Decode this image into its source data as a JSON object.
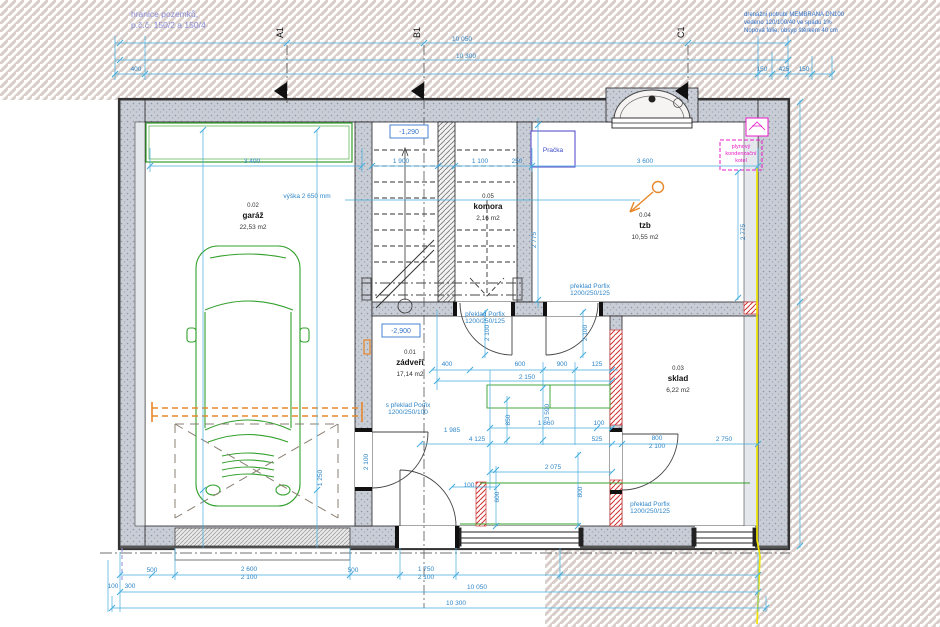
{
  "drawing": {
    "site_note": {
      "line1": "hranice pozemků,",
      "line2": "p.č.č. 150/2 a 150/4"
    },
    "drain_note": {
      "line1": "drenážní potrubí MEMBRANA DN100",
      "line2": "vedeno 120/100/40 ve spádu 1%",
      "line3": "Nopová fólie, obsyp štěrkem 40 cm"
    },
    "section_markers": {
      "a": "A1",
      "b": "B1",
      "c": "C1"
    },
    "rooms": [
      {
        "number": "0.01",
        "name": "zádveří",
        "area": "17,14 m2"
      },
      {
        "number": "0.02",
        "name": "garáž",
        "area": "22,53 m2"
      },
      {
        "number": "0.03",
        "name": "sklad",
        "area": "6,22 m2"
      },
      {
        "number": "0.04",
        "name": "tzb",
        "area": "10,55 m2"
      },
      {
        "number": "0.05",
        "name": "komora",
        "area": "2,16 m2"
      }
    ],
    "levels": {
      "stair": "-1,290",
      "floor": "-2,900"
    },
    "equipment": {
      "washer": "Pračka",
      "boiler_line1": "plynový",
      "boiler_line2": "kondenzační",
      "boiler_line3": "kotel"
    },
    "colors": {
      "dim": "#2f86c8",
      "dimline": "#45aede",
      "green": "#33a02c",
      "orange": "#e8872a",
      "magenta": "#e81cc8",
      "violet": "#8d8fd6",
      "red": "#cf3333",
      "yellow": "#f0e400"
    },
    "dim_labels": [
      {
        "t": "10 050",
        "x": 462,
        "y": 41
      },
      {
        "t": "10 300",
        "x": 466,
        "y": 58
      },
      {
        "t": "150",
        "x": 762,
        "y": 71
      },
      {
        "t": "425",
        "x": 784,
        "y": 71
      },
      {
        "t": "150",
        "x": 804,
        "y": 71
      },
      {
        "t": "400",
        "x": 136,
        "y": 71
      },
      {
        "t": "3 400",
        "x": 252,
        "y": 163
      },
      {
        "t": "1 900",
        "x": 401,
        "y": 163
      },
      {
        "t": "1 100",
        "x": 480,
        "y": 163
      },
      {
        "t": "250",
        "x": 517,
        "y": 163
      },
      {
        "t": "3 600",
        "x": 645,
        "y": 163
      },
      {
        "t": "výška 2 650 mm",
        "x": 307,
        "y": 198
      },
      {
        "t": "2 775",
        "x": 745,
        "y": 232,
        "r": -90
      },
      {
        "t": "2 775",
        "x": 536,
        "y": 240,
        "r": -90
      },
      {
        "t": "1 250",
        "x": 322,
        "y": 478,
        "r": -90
      },
      {
        "t": "2 100",
        "x": 368,
        "y": 462,
        "r": -90
      },
      {
        "t": "400",
        "x": 447,
        "y": 366
      },
      {
        "t": "600",
        "x": 520,
        "y": 366
      },
      {
        "t": "900",
        "x": 562,
        "y": 366
      },
      {
        "t": "125",
        "x": 597,
        "y": 366
      },
      {
        "t": "2 150",
        "x": 527,
        "y": 379
      },
      {
        "t": "3 590",
        "x": 549,
        "y": 412,
        "r": -90
      },
      {
        "t": "850",
        "x": 510,
        "y": 420,
        "r": -90
      },
      {
        "t": "2 100",
        "x": 489,
        "y": 333,
        "r": -90
      },
      {
        "t": "2 100",
        "x": 587,
        "y": 333,
        "r": -90
      },
      {
        "t": "1 860",
        "x": 546,
        "y": 425
      },
      {
        "t": "100",
        "x": 599,
        "y": 425
      },
      {
        "t": "1 985",
        "x": 452,
        "y": 432
      },
      {
        "t": "4 125",
        "x": 477,
        "y": 441
      },
      {
        "t": "525",
        "x": 597,
        "y": 441
      },
      {
        "t": "800",
        "x": 657,
        "y": 440
      },
      {
        "t": "2 100",
        "x": 657,
        "y": 448
      },
      {
        "t": "2 750",
        "x": 724,
        "y": 441
      },
      {
        "t": "2 075",
        "x": 553,
        "y": 469
      },
      {
        "t": "100",
        "x": 469,
        "y": 487
      },
      {
        "t": "600",
        "x": 499,
        "y": 497,
        "r": -90
      },
      {
        "t": "800",
        "x": 582,
        "y": 492,
        "r": -90
      },
      {
        "t": "500",
        "x": 152,
        "y": 572
      },
      {
        "t": "2 600",
        "x": 249,
        "y": 571
      },
      {
        "t": "2 100",
        "x": 249,
        "y": 579
      },
      {
        "t": "500",
        "x": 353,
        "y": 572
      },
      {
        "t": "1 750",
        "x": 426,
        "y": 571
      },
      {
        "t": "2 100",
        "x": 426,
        "y": 579
      },
      {
        "t": "100",
        "x": 113,
        "y": 588
      },
      {
        "t": "300",
        "x": 130,
        "y": 588
      },
      {
        "t": "10 050",
        "x": 477,
        "y": 589
      },
      {
        "t": "10 300",
        "x": 456,
        "y": 605
      },
      {
        "t": "překlad Porfix",
        "x": 485,
        "y": 316
      },
      {
        "t": "1200/250/125",
        "x": 485,
        "y": 323
      },
      {
        "t": "překlad Porfix",
        "x": 590,
        "y": 288
      },
      {
        "t": "1200/250/125",
        "x": 590,
        "y": 295
      },
      {
        "t": "s překlad Porfix",
        "x": 408,
        "y": 407
      },
      {
        "t": "1200/250/100",
        "x": 408,
        "y": 414
      },
      {
        "t": "překlad Porfix",
        "x": 650,
        "y": 506
      },
      {
        "t": "1200/250/125",
        "x": 650,
        "y": 513
      }
    ]
  }
}
